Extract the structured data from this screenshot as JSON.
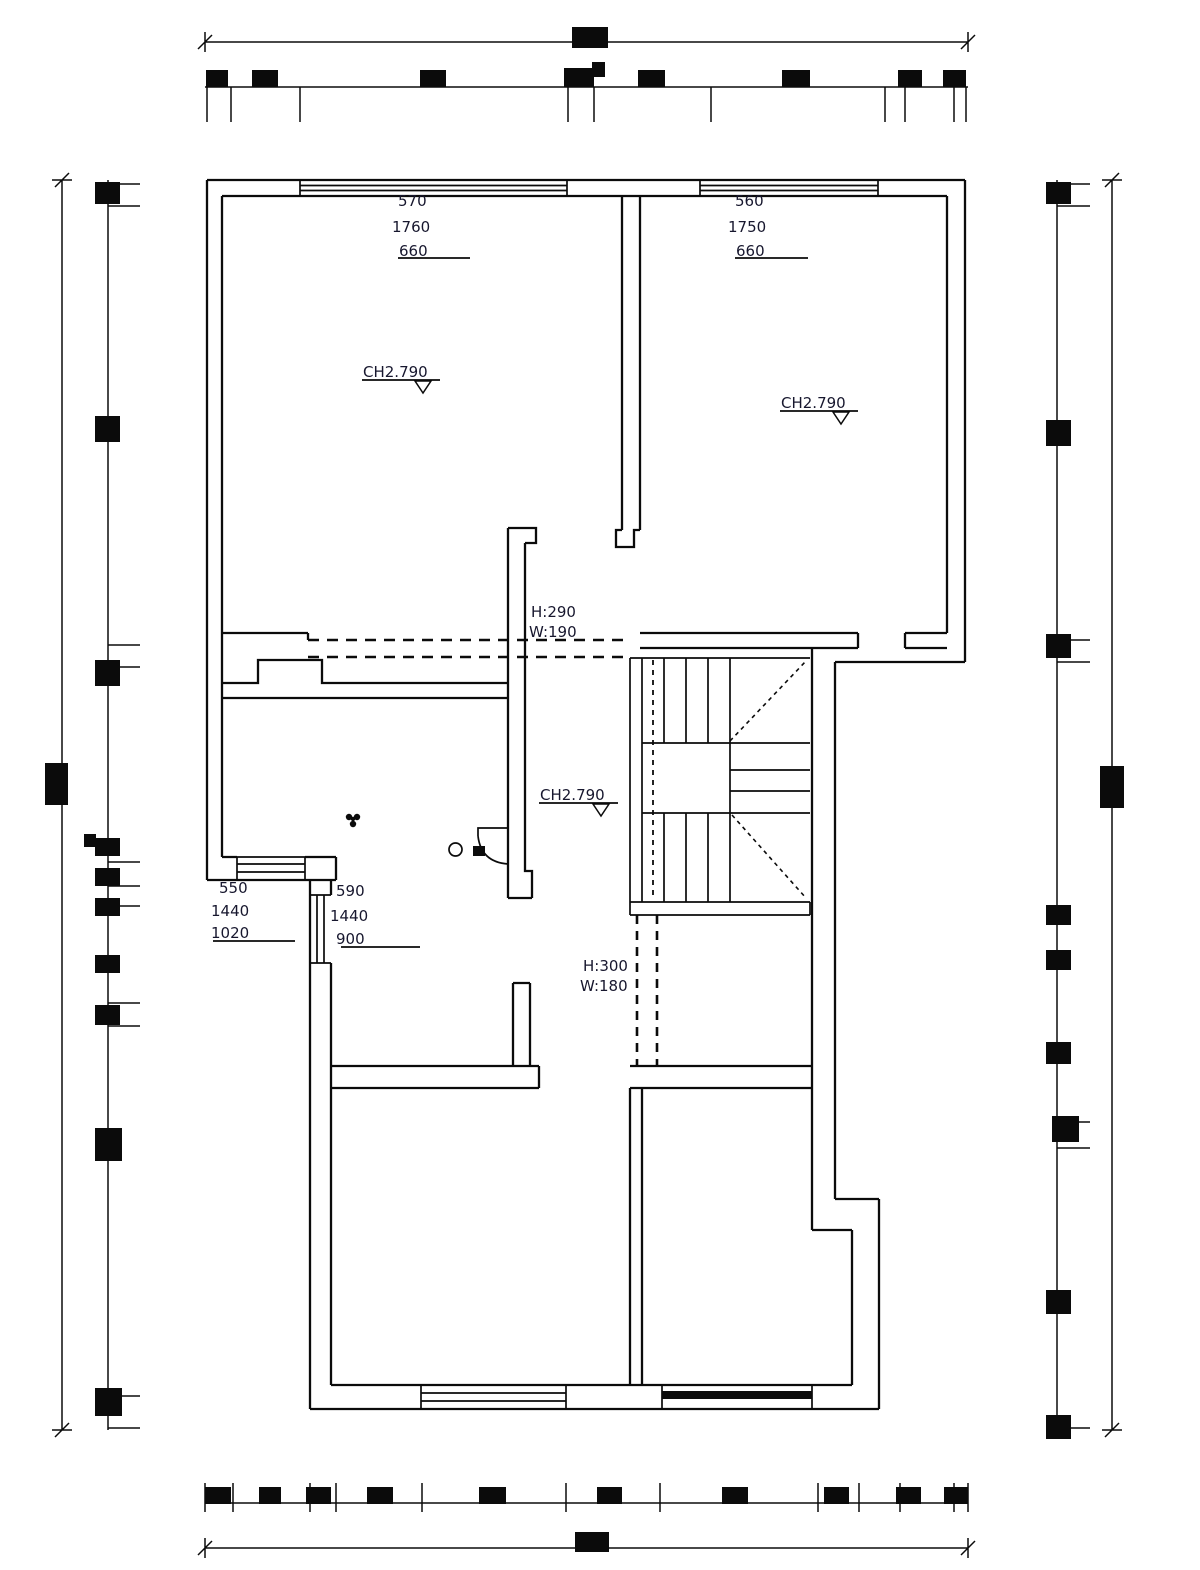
{
  "meta": {
    "drawing_type": "architectural floor plan",
    "ink_color": "#0b0b0b",
    "background_color": "#ffffff"
  },
  "labels": {
    "win_top_left": {
      "sill": "570",
      "width": "1760",
      "height": "660"
    },
    "win_top_right": {
      "sill": "560",
      "width": "1750",
      "height": "660"
    },
    "bay_left": {
      "sill": "550",
      "width": "1440",
      "height": "1020"
    },
    "bay_bottom": {
      "sill": "590",
      "width": "1440",
      "height": "900"
    },
    "ch_top_left": "CH2.790",
    "ch_top_right": "CH2.790",
    "ch_hall": "CH2.790",
    "opening_hall_h": "H:290",
    "opening_hall_w": "W:190",
    "opening_corridor_h": "H:300",
    "opening_corridor_w": "W:180"
  }
}
